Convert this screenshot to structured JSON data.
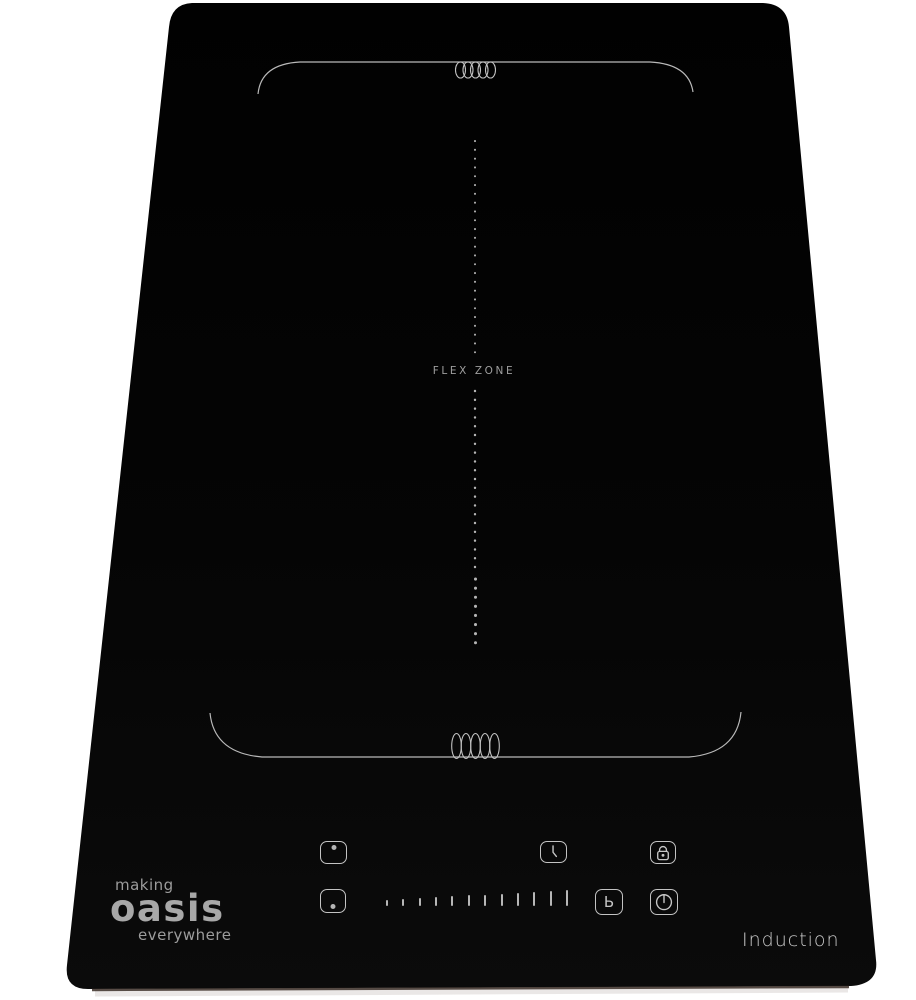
{
  "branding": {
    "line1": "making",
    "line2": "oasis",
    "line3": "everywhere",
    "product_label": "Induction"
  },
  "surface": {
    "flex_zone_label": "FLEX ZONE",
    "glass_color": "#050505",
    "marking_color": "#bdbdbd",
    "logo_color": "#a2a2a2"
  },
  "controls": {
    "zone_select_upper": {
      "icon": "dot-top"
    },
    "zone_select_lower": {
      "icon": "dot-bottom"
    },
    "timer": {
      "icon": "clock"
    },
    "child_lock": {
      "icon": "padlock"
    },
    "boost": {
      "glyph": "Ь"
    },
    "power": {
      "icon": "power"
    },
    "power_slider": {
      "tick_count": 12
    }
  }
}
